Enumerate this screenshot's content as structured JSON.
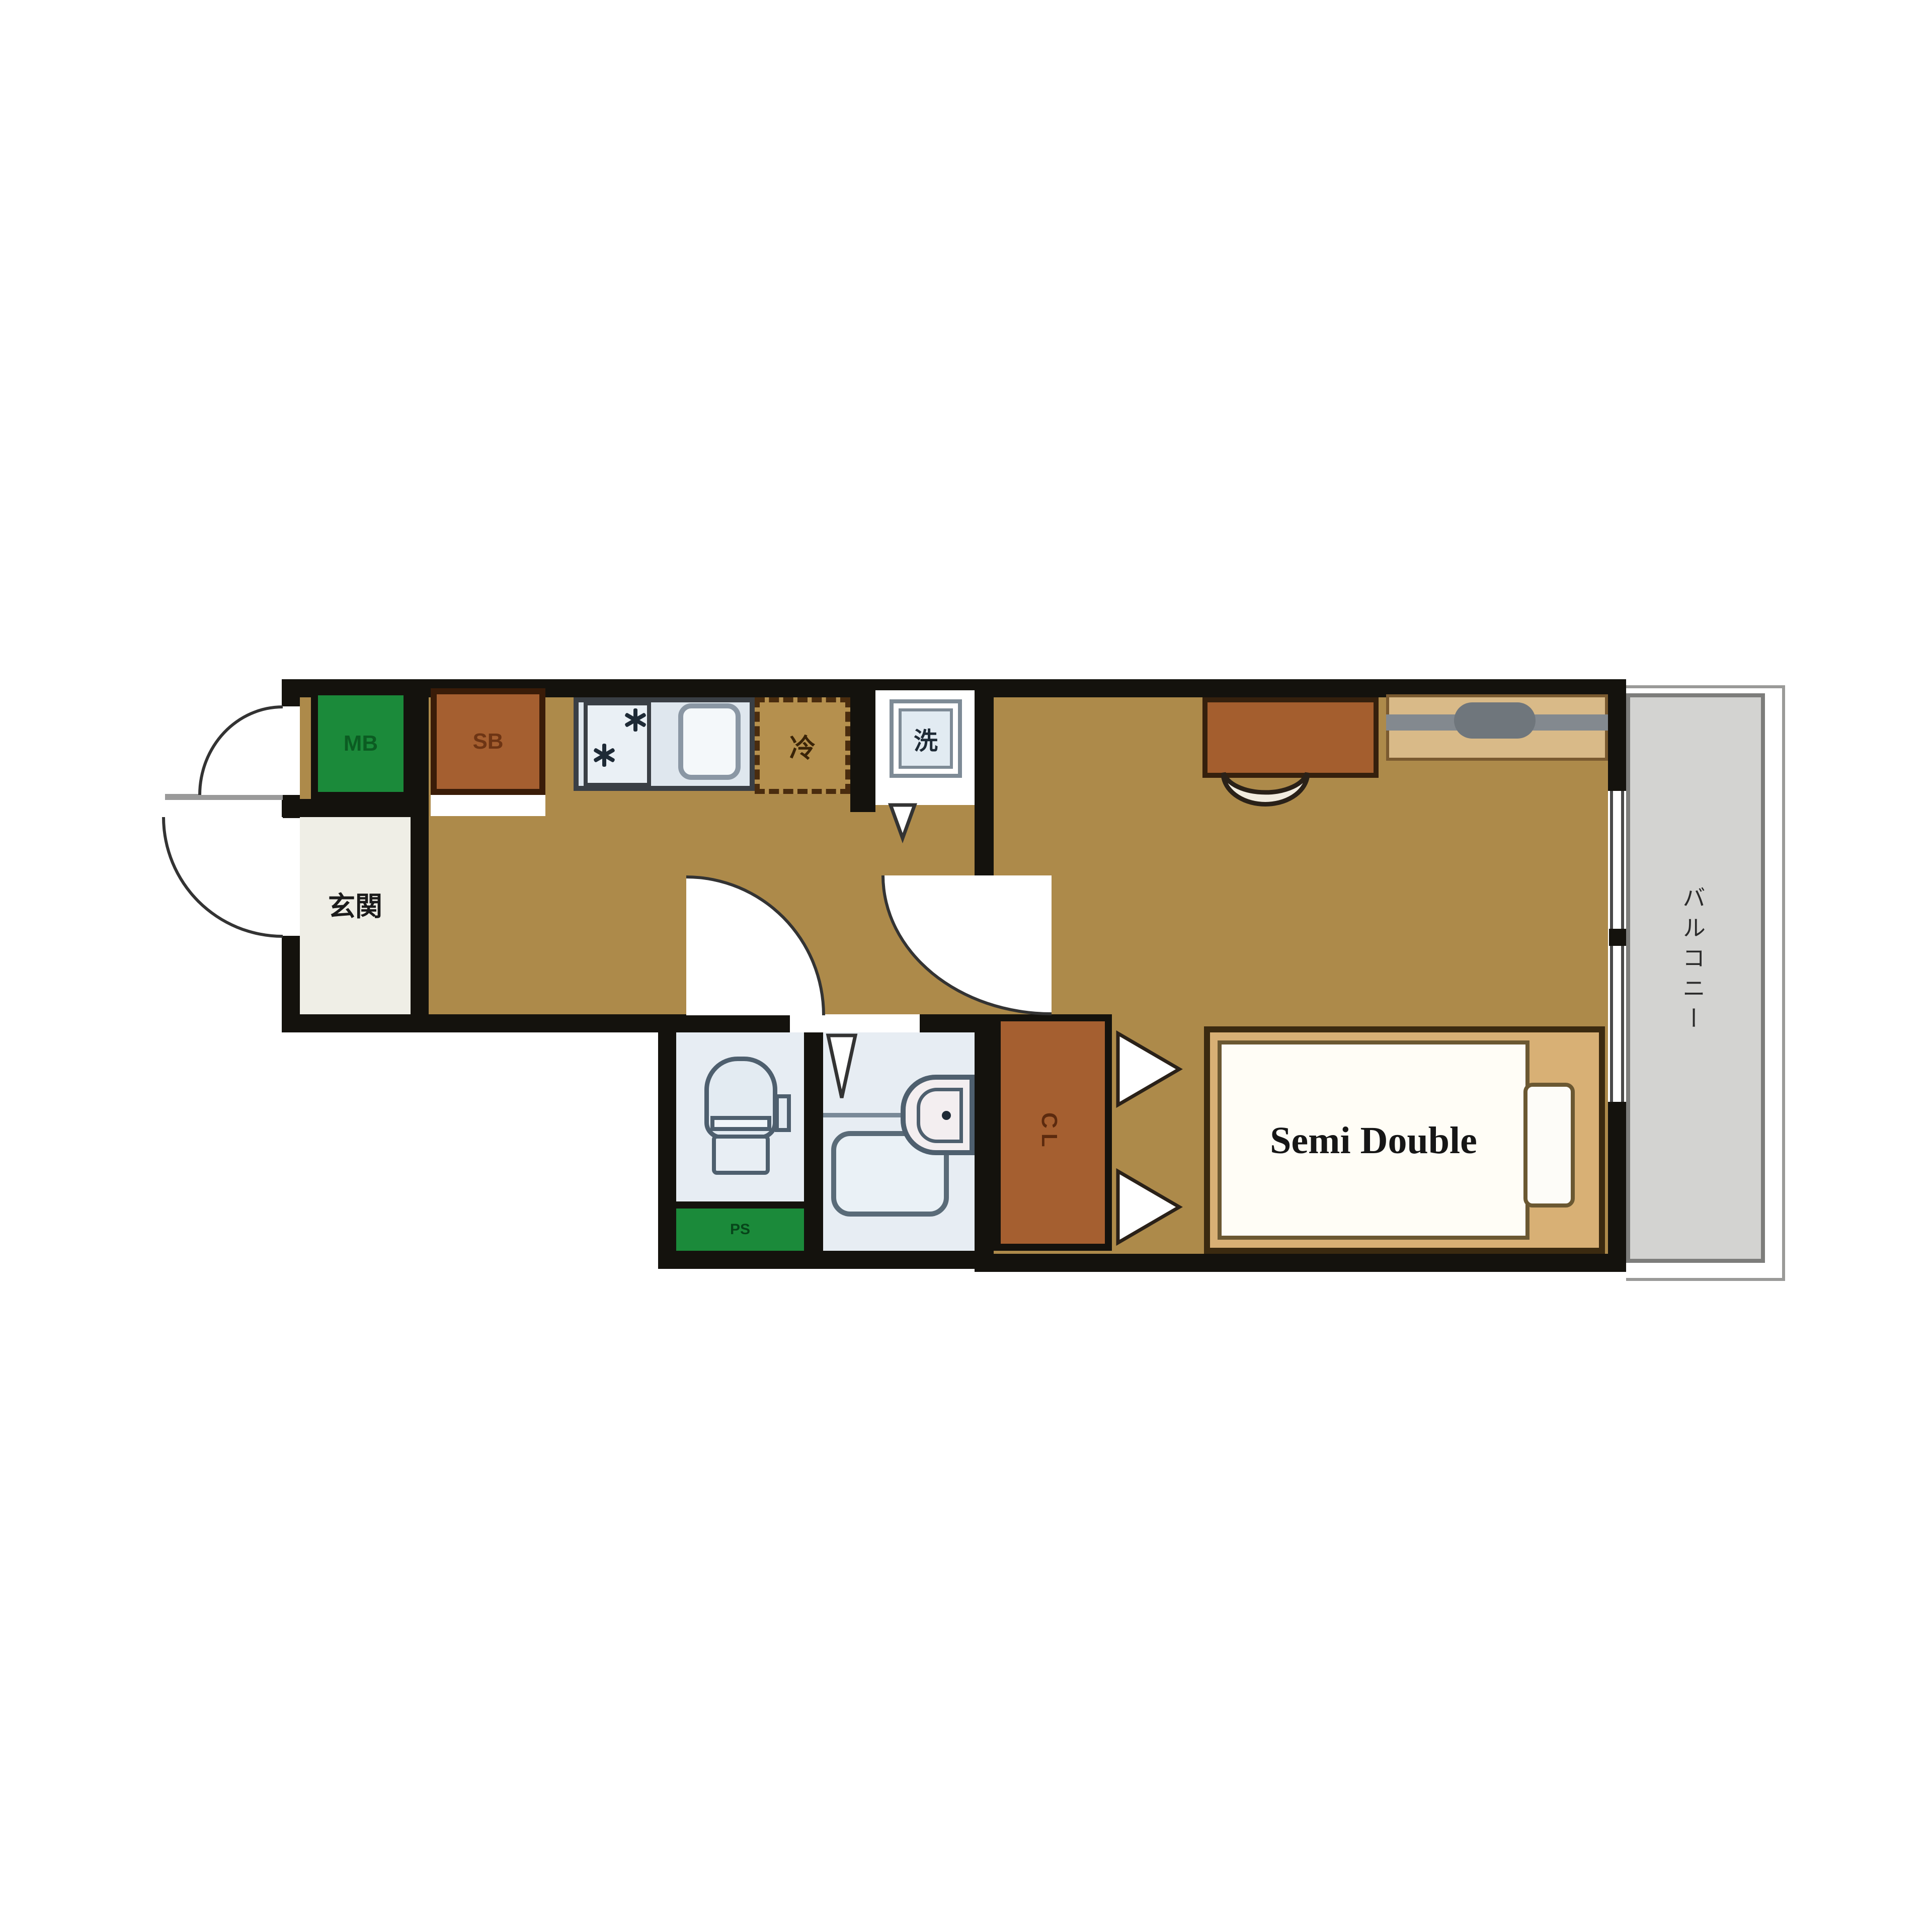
{
  "title": "1K apartment floor plan",
  "labels": {
    "meter_box": "MB",
    "shoe_box": "SB",
    "refrigerator": "冷",
    "washing_machine": "洗",
    "entrance": "玄関",
    "pipe_space": "PS",
    "closet": "CL",
    "bed": "Semi Double",
    "balcony": "バルコニー"
  },
  "colors": {
    "wall": "#14120d",
    "floor": "#ad8a4a",
    "accent_green": "#1b8a3a",
    "accent_brown": "#a55f30",
    "wet_area_floor": "#e7edf3",
    "kitchen_counter": "#dfe7ee",
    "balcony_floor": "#d3d3d1",
    "bed_frame": "#d8b075",
    "entrance_floor": "#efeee6",
    "counter_wood": "#d9ba88"
  },
  "icons": [
    "stove-icon",
    "sink-icon",
    "washing-machine-icon",
    "refrigerator-dashed-box",
    "toilet-icon",
    "bathtub-icon",
    "washbasin-icon",
    "bed",
    "pillow",
    "desk",
    "chair-arc-icon",
    "door-swing-icon",
    "folding-door-icon",
    "window",
    "balcony-rail"
  ]
}
